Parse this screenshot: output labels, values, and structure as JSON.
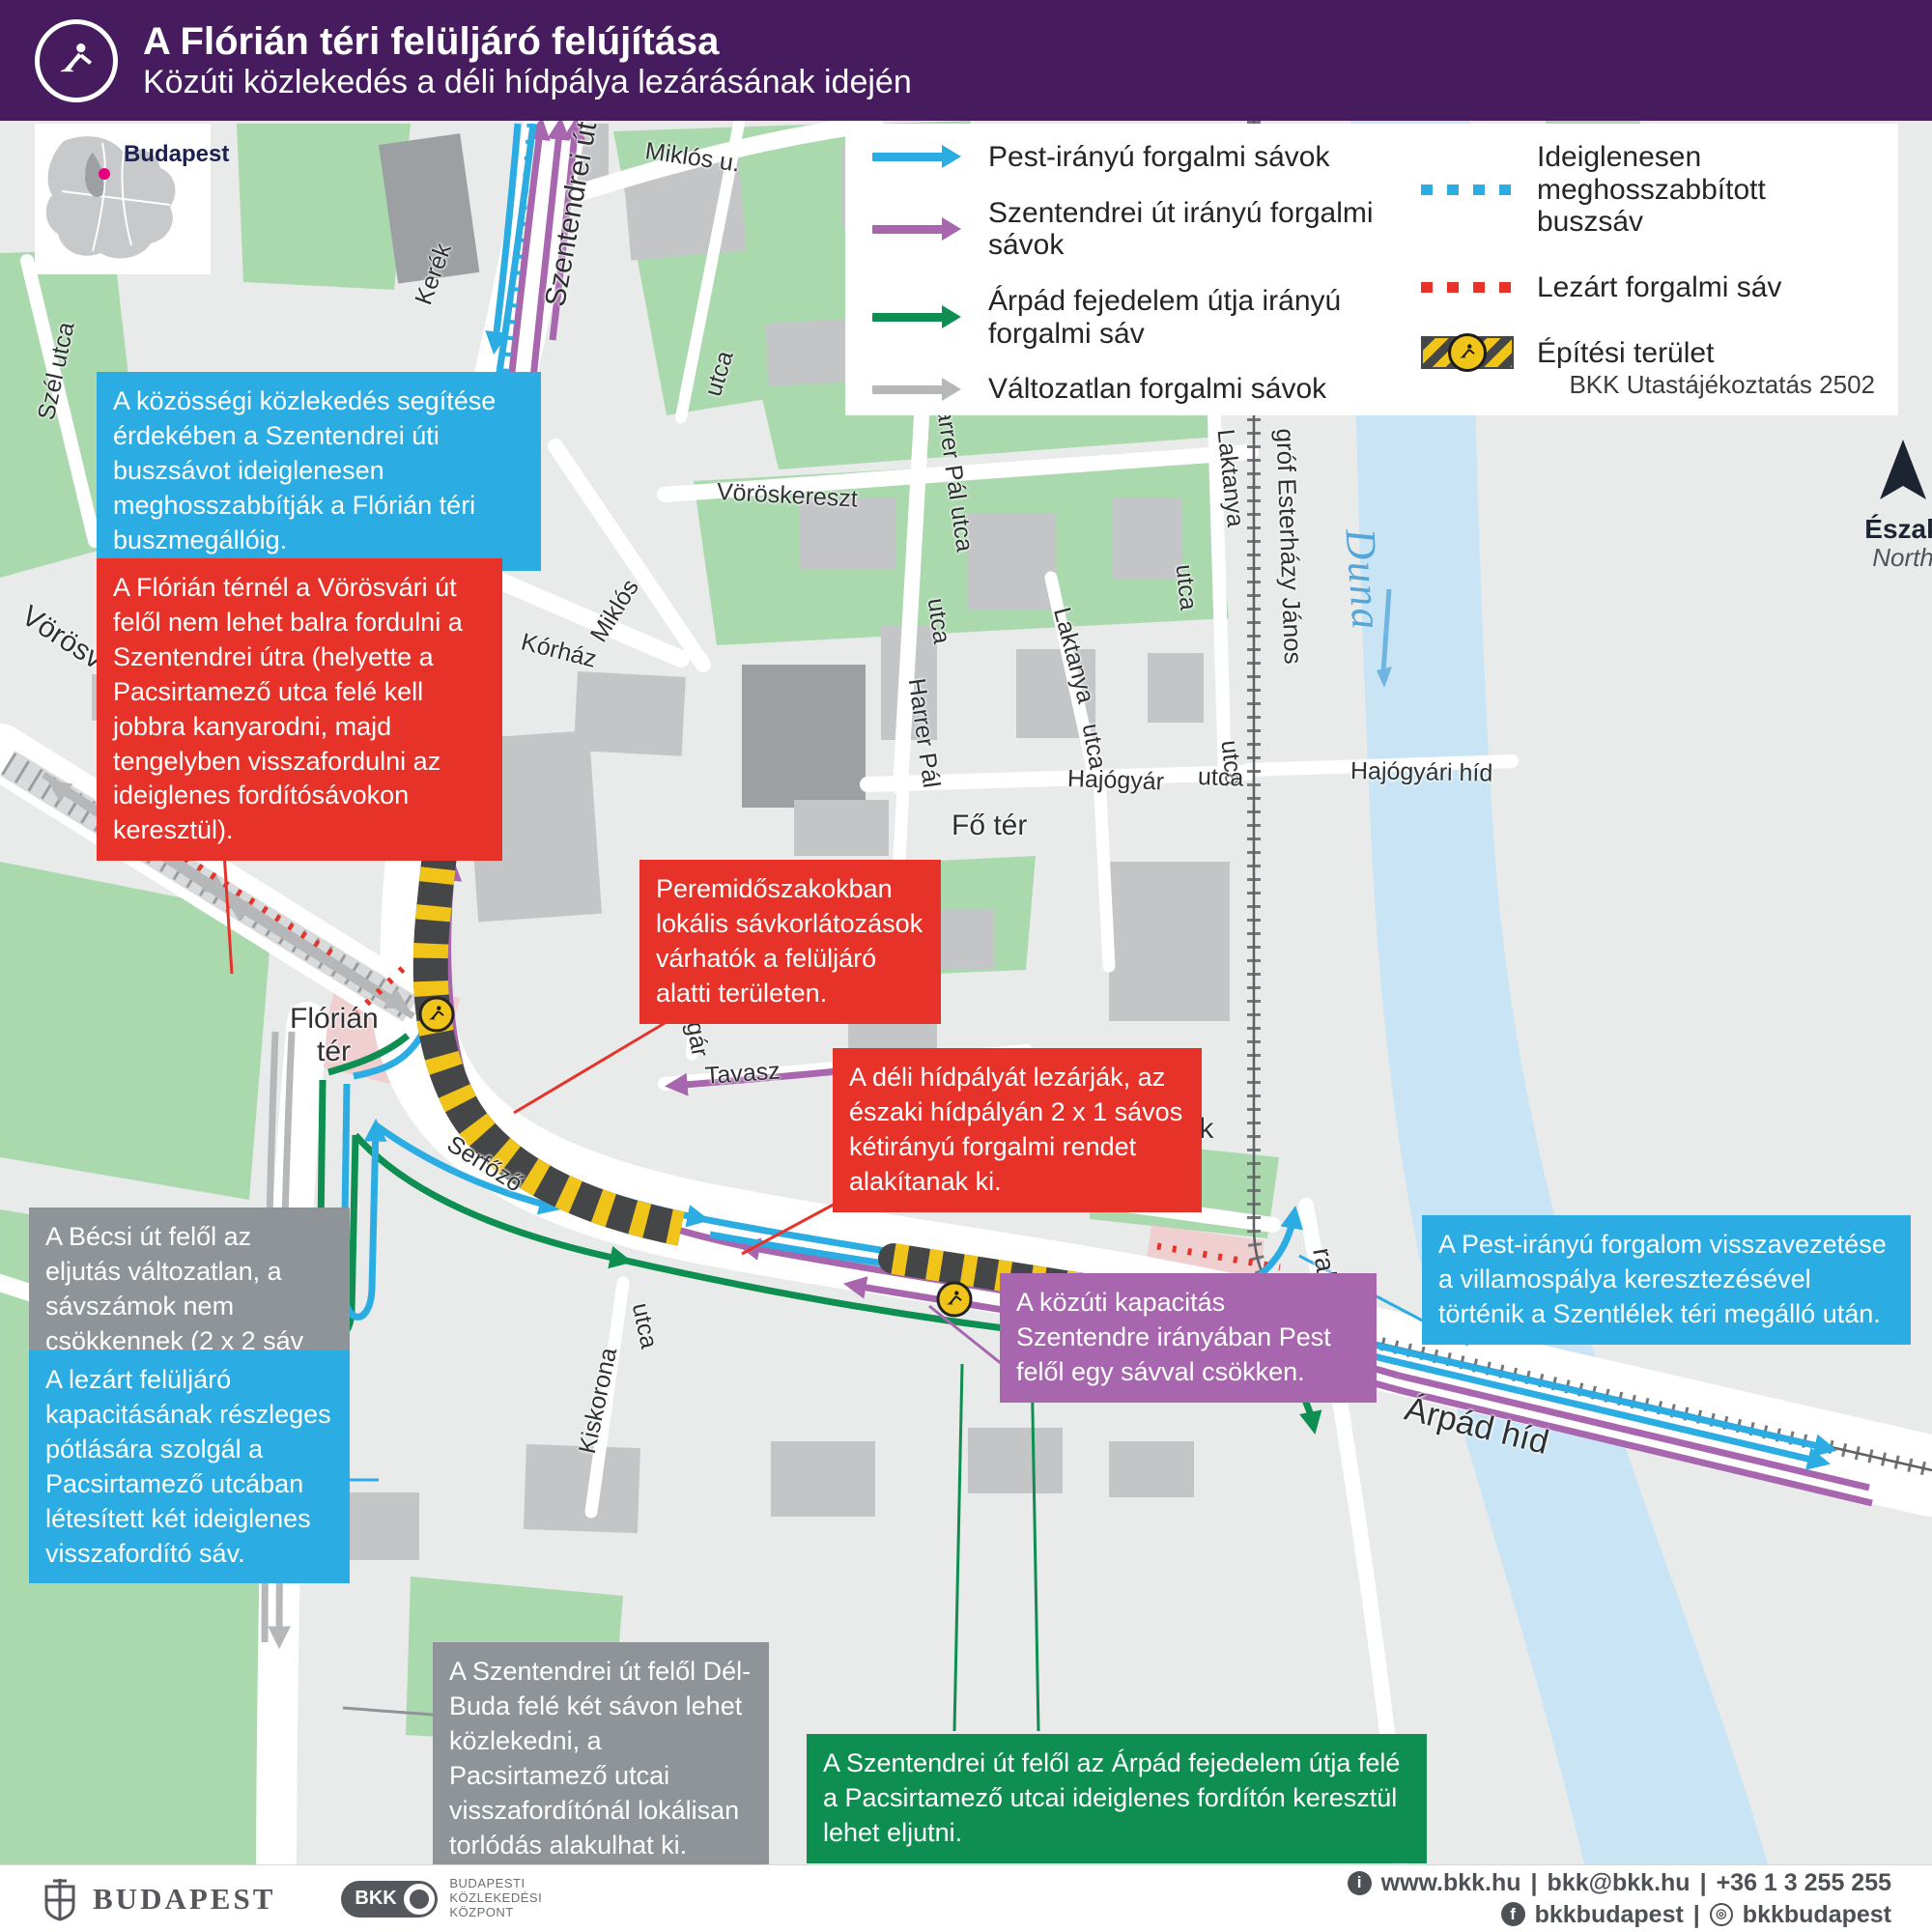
{
  "header": {
    "title": "A Flórián téri felüljáró felújítása",
    "subtitle": "Közúti közlekedés a déli hídpálya lezárásának idején"
  },
  "inset": {
    "label": "Budapest"
  },
  "legend": {
    "items": [
      {
        "key": "pest",
        "label": "Pest-irányú forgalmi sávok",
        "color": "#2bace3",
        "style": "arrow"
      },
      {
        "key": "szentendrei",
        "label": "Szentendrei út irányú forgalmi sávok",
        "color": "#a766ae",
        "style": "arrow"
      },
      {
        "key": "arpad",
        "label": "Árpád fejedelem útja irányú forgalmi sáv",
        "color": "#0e8f51",
        "style": "arrow"
      },
      {
        "key": "unchanged",
        "label": "Változatlan forgalmi sávok",
        "color": "#b5b7b9",
        "style": "arrow"
      },
      {
        "key": "bus",
        "label": "Ideiglenesen meghosszabbított buszsáv",
        "color": "#2bace3",
        "style": "dotted"
      },
      {
        "key": "closed",
        "label": "Lezárt forgalmi sáv",
        "color": "#e63229",
        "style": "dotted"
      },
      {
        "key": "construction",
        "label": "Építési terület",
        "color": "#f0c419",
        "style": "hatch"
      }
    ],
    "note": "BKK Utastájékoztatás 2502"
  },
  "compass": {
    "north_hu": "Észak",
    "north_en": "North"
  },
  "callouts": {
    "bus_lane": "A közösségi közlekedés segítése érdekében a Szentendrei úti buszsávot ideiglenesen meghosszabbítják a Flórián téri buszmegállóig.",
    "no_left_turn": "A Flórián térnél a Vörösvári út felől nem lehet balra fordulni a Szentendrei útra (helyette a Pacsirtamező utca felé kell jobbra kanyarodni, majd tengelyben visszafordulni az ideiglenes fordítósávokon keresztül).",
    "peak_restrictions": "Peremidőszakokban lokális sávkorlátozások várhatók a felüljáró alatti területen.",
    "south_closure": "A déli hídpályát lezárják, az északi hídpályán 2 x 1 sávos kétirányú forgalmi rendet alakítanak ki.",
    "becsi_unchanged": "A Bécsi út felől az eljutás változatlan, a sávszámok nem csökkennek (2 x 2 sáv marad).",
    "turnaround": "A lezárt felüljáró kapacitásának részleges pótlására szolgál a Pacsirtamező utcában létesített két ideiglenes visszafordító sáv.",
    "capacity": "A közúti kapacitás Szentendre irányában Pest felől egy sávval csökken.",
    "pest_return": "A Pest-irányú forgalom visszavezetése a villamospálya keresztezésével történik a Szentlélek téri megálló után.",
    "del_buda": "A Szentendrei út felől Dél-Buda felé két sávon lehet közlekedni, a Pacsirtamező utcai visszafordítónál lokálisan torlódás alakulhat ki.",
    "arpad_access": "A Szentendrei út felől az Árpád fejedelem útja felé a Pacsirtamező utcai ideiglenes fordítón keresztül lehet eljutni."
  },
  "streets": {
    "szentendrei_ut": "Szentendrei út",
    "miklos_u": "Miklós u.",
    "miklos": "Miklós",
    "kerek": "Kerék",
    "szel_utca": "Szél utca",
    "korhaz_u": "Kórház u.",
    "korhaz": "Kórház",
    "vorosvari_ut": "Vörösvári út",
    "voroskereszt": "Vöröskereszt",
    "harrer_pal_utca": "Harrer Pál utca",
    "harrer_pal": "Harrer Pál",
    "laktanya": "Laktanya",
    "utca": "utca",
    "grof_esterhazy_janos": "gróf Esterházy János",
    "duna": "Duna",
    "hajogyar": "Hajógyár",
    "hajogyari_hid": "Hajógyári híd",
    "fo_ter": "Fő tér",
    "polgar": "Polgár",
    "hidfo": "Hídfő",
    "tavasz": "Tavasz",
    "florian": "Flórián",
    "szentlelek": "Szentlélek",
    "ter": "tér",
    "serfozo": "Serfőző",
    "pacsirtamezo": "Pacsirtamező",
    "kiscelli": "Kiscelli",
    "kiskorona": "Kiskorona",
    "rakpart": "rakpart",
    "arpad_hid": "Árpád híd"
  },
  "colors": {
    "header_purple": "#471c5e",
    "bkk_blue": "#2bace3",
    "closed_red": "#e63229",
    "szentendrei_purple": "#a766ae",
    "arpad_green": "#0e8f51",
    "unchanged_gray": "#b5b7b9",
    "construction_yellow": "#f0c419",
    "construction_dark": "#454647",
    "water_blue": "#c9e5f5",
    "park_green": "#abd9ae"
  },
  "footer": {
    "budapest": "BUDAPEST",
    "bkk": "BKK",
    "bkk_org1": "BUDAPESTI",
    "bkk_org2": "KÖZLEKEDÉSI",
    "bkk_org3": "KÖZPONT",
    "contact_web": "www.bkk.hu",
    "contact_email": "bkk@bkk.hu",
    "contact_phone": "+36 1 3 255 255",
    "social_fb": "bkkbudapest",
    "social_ig": "bkkbudapest",
    "sep": "|"
  }
}
